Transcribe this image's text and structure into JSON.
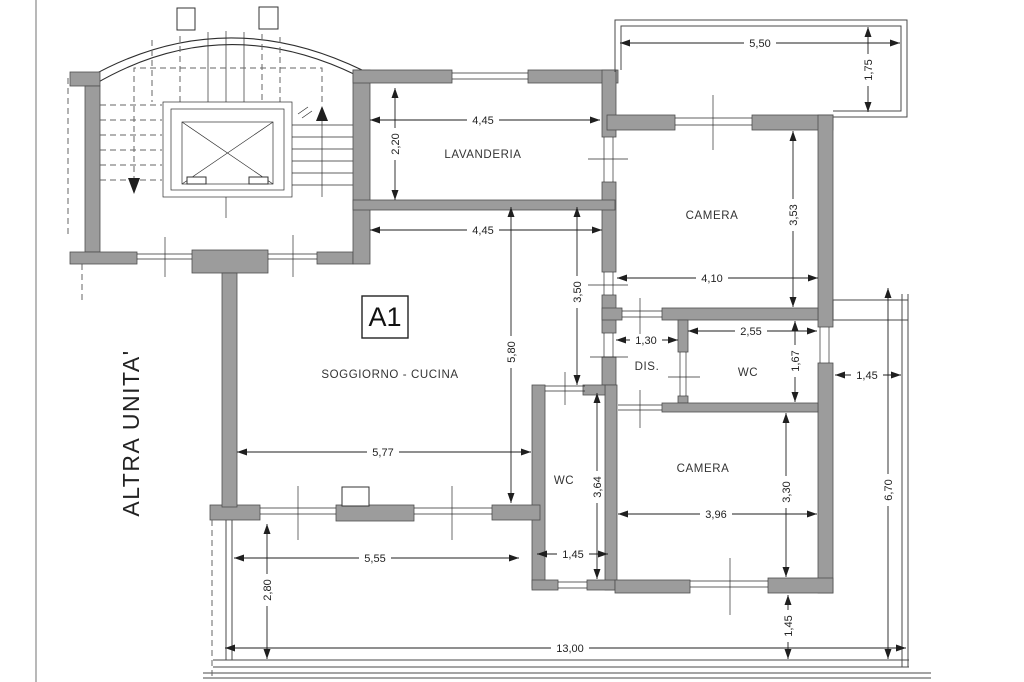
{
  "plan": {
    "unit_label": "A1",
    "adjacent_unit_label": "ALTRA UNITA'",
    "rooms": {
      "laundry": "LAVANDERIA",
      "bedroom_top": "CAMERA",
      "living": "SOGGIORNO - CUCINA",
      "hallway": "DIS.",
      "wc_top": "WC",
      "bedroom_bottom": "CAMERA",
      "wc_bottom": "WC"
    },
    "dimensions": {
      "terrace_width": "5,50",
      "terrace_depth": "1,75",
      "laundry_width": "4,45",
      "laundry_depth": "2,20",
      "living_top_width": "4,45",
      "bedroom_top_depth": "3,53",
      "bedroom_top_width": "4,10",
      "living_height": "5,80",
      "hall_height": "3,50",
      "hallway_width": "1,30",
      "wc_top_width": "2,55",
      "wc_top_depth": "1,67",
      "balcony_right_width": "1,45",
      "living_width": "5,77",
      "wc_bottom_depth": "3,64",
      "bedroom_bottom_depth": "3,30",
      "bedroom_bottom_width": "3,96",
      "wc_bottom_width": "1,45",
      "balcony_inner_width": "5,55",
      "balcony_bottom_depth": "2,80",
      "bedroom_bottom_offset": "1,45",
      "balcony_right_height": "6,70",
      "total_width": "13,00"
    },
    "colors": {
      "wall_fill": "#9c9c9c",
      "wall_stroke": "#4f4f4f",
      "line": "#2e2e2e",
      "dim": "#1f1f1f",
      "background": "#ffffff"
    }
  }
}
